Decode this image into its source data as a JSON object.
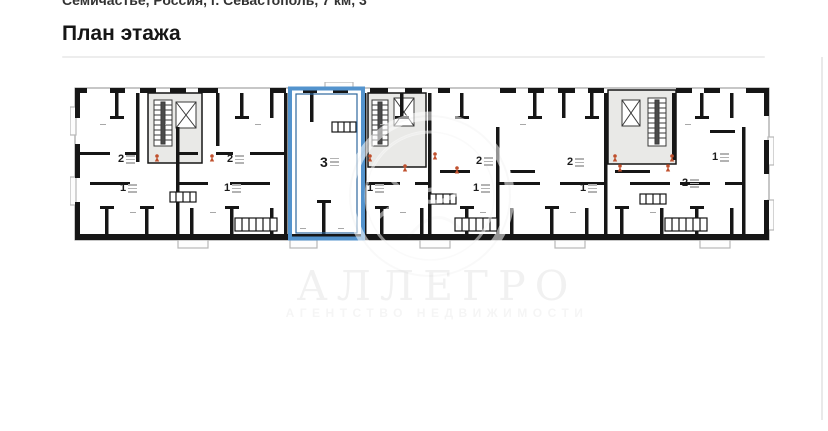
{
  "page": {
    "location_line": "Семичастье, Россия, г. Севастополь, 7 км, 3",
    "title": "План этажа"
  },
  "watermark": {
    "brand": "АЛЛЕГРО",
    "tagline": "АГЕНТСТВО НЕДВИЖИМОСТИ"
  },
  "plan": {
    "highlight_color": "#5393cd",
    "marker_color": "#c0512e",
    "stair_core_color": "#e9e9e7",
    "wall_color": "#161616",
    "units": [
      {
        "label": "2"
      },
      {
        "label": "1"
      },
      {
        "label": "2"
      },
      {
        "label": "1"
      },
      {
        "label": "3"
      },
      {
        "label": "1"
      },
      {
        "label": "2"
      },
      {
        "label": "1"
      },
      {
        "label": "2"
      },
      {
        "label": "1"
      },
      {
        "label": "2"
      },
      {
        "label": "1"
      }
    ],
    "highlighted_unit": {
      "label": "3"
    }
  }
}
